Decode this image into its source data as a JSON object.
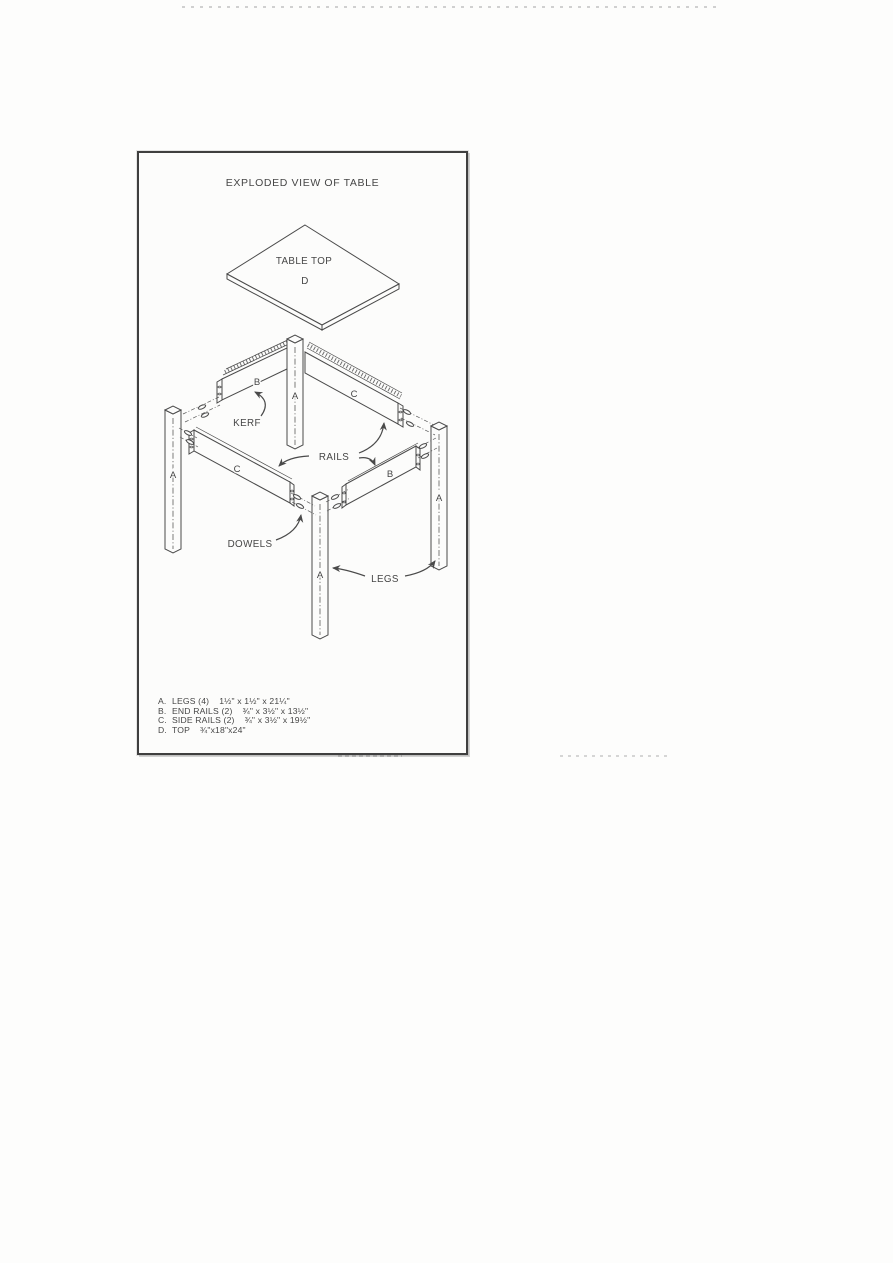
{
  "figure": {
    "title": "EXPLODED VIEW OF TABLE",
    "diagram": {
      "table_top_label": "TABLE TOP",
      "table_top_letter": "D",
      "kerf_label": "KERF",
      "rails_label": "RAILS",
      "dowels_label": "DOWELS",
      "legs_label": "LEGS",
      "leg_letter": "A",
      "end_rail_letter": "B",
      "side_rail_letter": "C"
    },
    "parts_list": [
      {
        "id": "A.",
        "name": "LEGS (4)",
        "dims": "1½\" x 1½\" x 21¼\""
      },
      {
        "id": "B.",
        "name": "END RAILS (2)",
        "dims": "¾\" x 3½\" x 13½\""
      },
      {
        "id": "C.",
        "name": "SIDE RAILS (2)",
        "dims": "¾\" x 3½\" x 19½\""
      },
      {
        "id": "D.",
        "name": "TOP",
        "dims": "¾\"x18\"x24\""
      }
    ],
    "colors": {
      "ink": "#4a4a4a",
      "paper": "#fcfcfb",
      "frame_border": "#3f3f3f"
    }
  }
}
